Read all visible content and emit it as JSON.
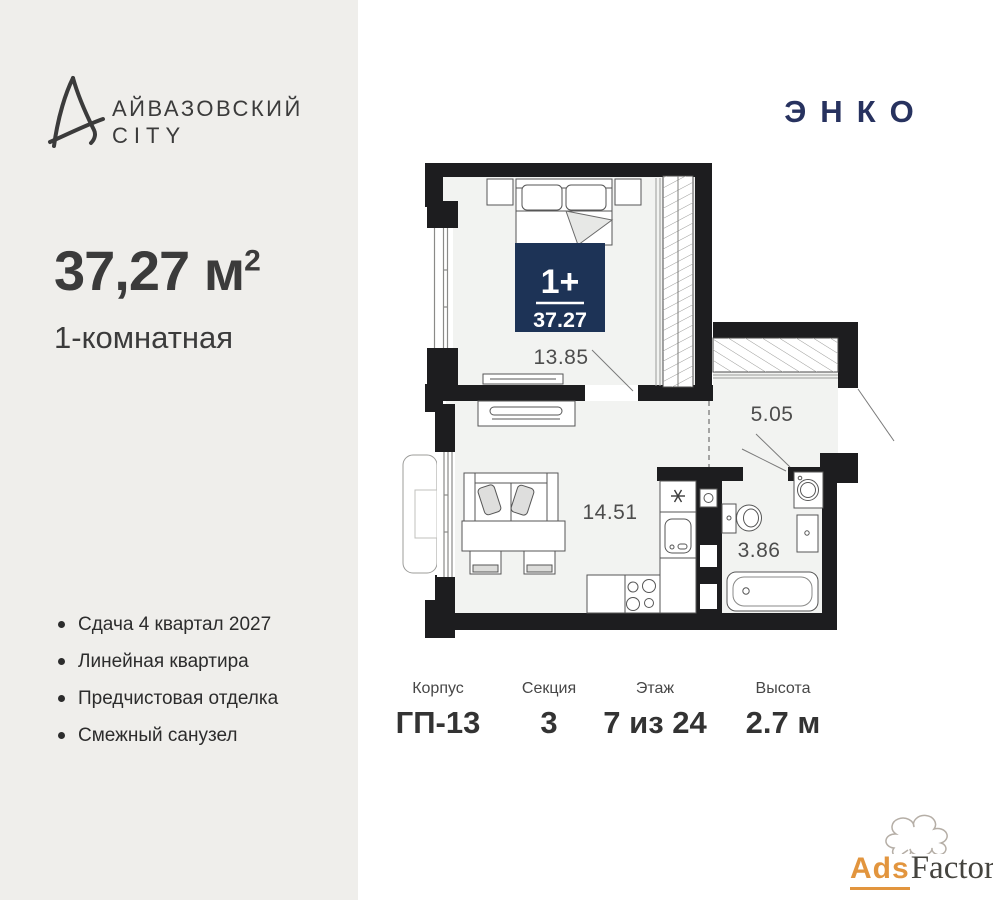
{
  "brand": {
    "line1": "АЙВАЗОВСКИЙ",
    "line2": "CITY"
  },
  "developer": {
    "name": "ЭНКО"
  },
  "apartment": {
    "area_value": "37,27",
    "area_unit": " м",
    "area_exponent": "2",
    "type_label": "1-комнатная"
  },
  "features": [
    "Сдача 4 квартал 2027",
    "Линейная квартира",
    "Предчистовая отделка",
    "Смежный санузел"
  ],
  "plan": {
    "badge": {
      "rooms": "1+",
      "area": "37.27",
      "bg_color": "#1d3356"
    },
    "rooms": {
      "bedroom_area": "13.85",
      "hallway_area": "5.05",
      "living_area": "14.51",
      "bathroom_area": "3.86"
    }
  },
  "details": [
    {
      "label": "Корпус",
      "value": "ГП-13"
    },
    {
      "label": "Секция",
      "value": "3"
    },
    {
      "label": "Этаж",
      "value": "7 из 24"
    },
    {
      "label": "Высота",
      "value": "2.7 м"
    }
  ],
  "watermark": {
    "prefix": "Ads",
    "suffix": "Factory"
  },
  "colors": {
    "panel_bg": "#efeeeb",
    "wall": "#1d1d1f",
    "room_fill": "#f2f3f1",
    "badge_navy": "#1d3356",
    "developer_navy": "#27325f",
    "text_dark": "#3b3b3b",
    "watermark_orange": "#e2953e"
  }
}
